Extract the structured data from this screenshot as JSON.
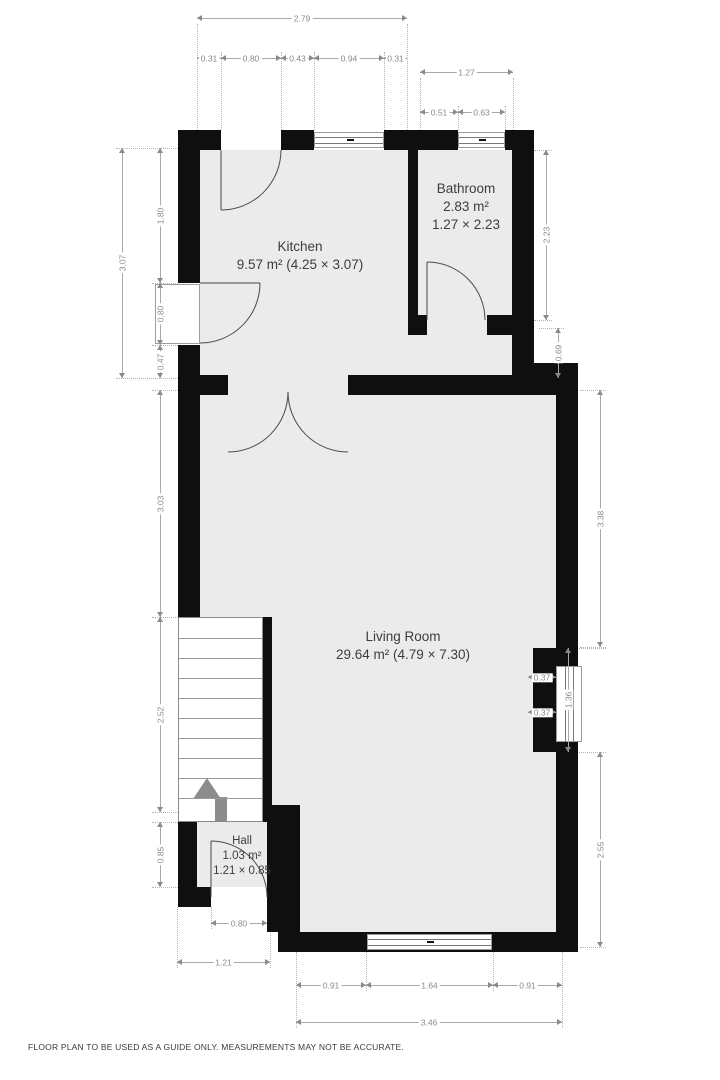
{
  "page": {
    "footer": "FLOOR PLAN TO BE USED AS A GUIDE ONLY. MEASUREMENTS MAY NOT BE ACCURATE."
  },
  "colors": {
    "wall": "#0f0f0f",
    "floor": "#ebebeb",
    "dim_text": "#8a8a8a",
    "room_text": "#3d3d3d",
    "stairs_arrow": "#8c8c8c"
  },
  "rooms": {
    "kitchen": {
      "name": "Kitchen",
      "line2": "9.57 m² (4.25 × 3.07)"
    },
    "bathroom": {
      "name": "Bathroom",
      "line2": "2.83 m²",
      "line3": "1.27 × 2.23"
    },
    "living_room": {
      "name": "Living Room",
      "line2": "29.64 m² (4.79 × 7.30)"
    },
    "hall": {
      "name": "Hall",
      "line2": "1.03 m²",
      "line3": "1.21 × 0.85"
    }
  },
  "stairs": {
    "tread_count": 9,
    "direction": "up"
  },
  "dimensions": [
    {
      "v": "2.79",
      "o": "h",
      "x": 197,
      "y": 18,
      "l": 210
    },
    {
      "v": "0.31",
      "o": "h",
      "x": 197,
      "y": 58,
      "l": 24
    },
    {
      "v": "0.80",
      "o": "h",
      "x": 221,
      "y": 58,
      "l": 60
    },
    {
      "v": "0.43",
      "o": "h",
      "x": 281,
      "y": 58,
      "l": 33
    },
    {
      "v": "0.94",
      "o": "h",
      "x": 314,
      "y": 58,
      "l": 70
    },
    {
      "v": "0.31",
      "o": "h",
      "x": 384,
      "y": 58,
      "l": 23
    },
    {
      "v": "1.27",
      "o": "h",
      "x": 420,
      "y": 72,
      "l": 93
    },
    {
      "v": "0.51",
      "o": "h",
      "x": 420,
      "y": 112,
      "l": 38
    },
    {
      "v": "0.63",
      "o": "h",
      "x": 458,
      "y": 112,
      "l": 47
    },
    {
      "v": "0.37",
      "o": "h",
      "x": 528,
      "y": 677,
      "l": 28
    },
    {
      "v": "0.37",
      "o": "h",
      "x": 528,
      "y": 712,
      "l": 28
    },
    {
      "v": "0.80",
      "o": "h",
      "x": 211,
      "y": 923,
      "l": 56
    },
    {
      "v": "1.21",
      "o": "h",
      "x": 177,
      "y": 962,
      "l": 93
    },
    {
      "v": "0.91",
      "o": "h",
      "x": 296,
      "y": 985,
      "l": 70
    },
    {
      "v": "1.64",
      "o": "h",
      "x": 366,
      "y": 985,
      "l": 127
    },
    {
      "v": "0.91",
      "o": "h",
      "x": 493,
      "y": 985,
      "l": 69
    },
    {
      "v": "3.46",
      "o": "h",
      "x": 296,
      "y": 1022,
      "l": 266
    },
    {
      "v": "3.07",
      "o": "v",
      "x": 122,
      "y": 148,
      "l": 230
    },
    {
      "v": "1.80",
      "o": "v",
      "x": 160,
      "y": 148,
      "l": 135
    },
    {
      "v": "0.80",
      "o": "v",
      "x": 160,
      "y": 283,
      "l": 62
    },
    {
      "v": "0.47",
      "o": "v",
      "x": 160,
      "y": 345,
      "l": 33
    },
    {
      "v": "3.03",
      "o": "v",
      "x": 160,
      "y": 390,
      "l": 227
    },
    {
      "v": "2.52",
      "o": "v",
      "x": 160,
      "y": 617,
      "l": 195
    },
    {
      "v": "0.85",
      "o": "v",
      "x": 160,
      "y": 822,
      "l": 65
    },
    {
      "v": "2.23",
      "o": "v",
      "x": 546,
      "y": 150,
      "l": 170
    },
    {
      "v": "0.69",
      "o": "v",
      "x": 558,
      "y": 328,
      "l": 50
    },
    {
      "v": "3.38",
      "o": "v",
      "x": 600,
      "y": 390,
      "l": 257
    },
    {
      "v": "1.36",
      "o": "v",
      "x": 568,
      "y": 648,
      "l": 104
    },
    {
      "v": "2.55",
      "o": "v",
      "x": 600,
      "y": 752,
      "l": 195
    }
  ],
  "extensions": [
    {
      "o": "v",
      "x": 197,
      "y": 24,
      "l": 106
    },
    {
      "o": "v",
      "x": 407,
      "y": 24,
      "l": 106
    },
    {
      "o": "v",
      "x": 221,
      "y": 52,
      "l": 78
    },
    {
      "o": "v",
      "x": 281,
      "y": 52,
      "l": 78
    },
    {
      "o": "v",
      "x": 314,
      "y": 52,
      "l": 78
    },
    {
      "o": "v",
      "x": 384,
      "y": 52,
      "l": 78
    },
    {
      "o": "v",
      "x": 420,
      "y": 78,
      "l": 52
    },
    {
      "o": "v",
      "x": 513,
      "y": 78,
      "l": 54
    },
    {
      "o": "v",
      "x": 458,
      "y": 106,
      "l": 24
    },
    {
      "o": "v",
      "x": 505,
      "y": 106,
      "l": 24
    },
    {
      "o": "h",
      "x": 116,
      "y": 148,
      "l": 62
    },
    {
      "o": "h",
      "x": 152,
      "y": 283,
      "l": 26
    },
    {
      "o": "h",
      "x": 152,
      "y": 345,
      "l": 26
    },
    {
      "o": "h",
      "x": 116,
      "y": 378,
      "l": 62
    },
    {
      "o": "h",
      "x": 152,
      "y": 390,
      "l": 26
    },
    {
      "o": "h",
      "x": 152,
      "y": 617,
      "l": 26
    },
    {
      "o": "h",
      "x": 152,
      "y": 812,
      "l": 26
    },
    {
      "o": "h",
      "x": 152,
      "y": 822,
      "l": 26
    },
    {
      "o": "h",
      "x": 152,
      "y": 887,
      "l": 26
    },
    {
      "o": "h",
      "x": 534,
      "y": 150,
      "l": 18
    },
    {
      "o": "h",
      "x": 534,
      "y": 320,
      "l": 18
    },
    {
      "o": "h",
      "x": 539,
      "y": 328,
      "l": 25
    },
    {
      "o": "h",
      "x": 539,
      "y": 378,
      "l": 25
    },
    {
      "o": "h",
      "x": 580,
      "y": 390,
      "l": 26
    },
    {
      "o": "h",
      "x": 580,
      "y": 647,
      "l": 26
    },
    {
      "o": "h",
      "x": 560,
      "y": 648,
      "l": 46
    },
    {
      "o": "h",
      "x": 560,
      "y": 752,
      "l": 46
    },
    {
      "o": "h",
      "x": 580,
      "y": 947,
      "l": 26
    },
    {
      "o": "v",
      "x": 296,
      "y": 952,
      "l": 76
    },
    {
      "o": "v",
      "x": 562,
      "y": 952,
      "l": 76
    },
    {
      "o": "v",
      "x": 366,
      "y": 952,
      "l": 39
    },
    {
      "o": "v",
      "x": 493,
      "y": 952,
      "l": 39
    },
    {
      "o": "v",
      "x": 211,
      "y": 907,
      "l": 22
    },
    {
      "o": "v",
      "x": 267,
      "y": 907,
      "l": 22
    },
    {
      "o": "v",
      "x": 177,
      "y": 907,
      "l": 61
    },
    {
      "o": "v",
      "x": 270,
      "y": 907,
      "l": 61
    }
  ]
}
